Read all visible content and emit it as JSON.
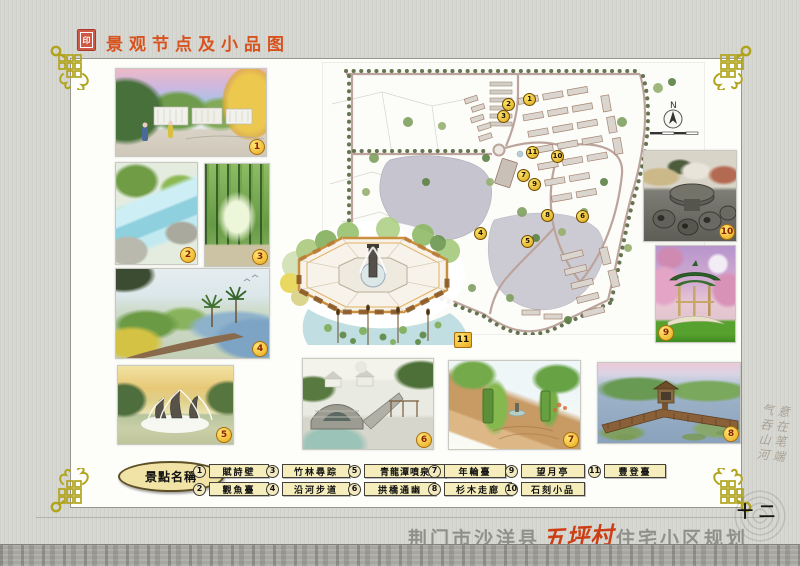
{
  "header": {
    "title": "景观节点及小品图"
  },
  "legend": {
    "title": "景點名稱",
    "items": [
      {
        "num": "1",
        "label": "賦詩壁"
      },
      {
        "num": "2",
        "label": "觀魚臺"
      },
      {
        "num": "3",
        "label": "竹林尋踪"
      },
      {
        "num": "4",
        "label": "沿河步道"
      },
      {
        "num": "5",
        "label": "青龍潭噴泉"
      },
      {
        "num": "6",
        "label": "拱橋通幽"
      },
      {
        "num": "7",
        "label": "年輪臺"
      },
      {
        "num": "8",
        "label": "杉木走廊"
      },
      {
        "num": "9",
        "label": "望月亭"
      },
      {
        "num": "10",
        "label": "石刻小品"
      },
      {
        "num": "11",
        "label": "豐登臺"
      }
    ]
  },
  "photos": {
    "badges": [
      "1",
      "2",
      "3",
      "4",
      "5",
      "6",
      "7",
      "8",
      "9",
      "10",
      "11"
    ]
  },
  "map": {
    "north_label": "N",
    "badges": [
      "1",
      "2",
      "3",
      "4",
      "5",
      "6",
      "7",
      "8",
      "9",
      "10",
      "11"
    ]
  },
  "footer": {
    "project_location": "荆门市沙洋县",
    "project_accent": "五坪村",
    "project_suffix": "住宅小区规划",
    "page_number": "十二"
  },
  "side_note": {
    "column1": "意在笔端",
    "column2": "气吞山河"
  },
  "colors": {
    "title_red": "#d8521e",
    "accent_red": "#cc3f14",
    "gold_ornament": "#b1a41d",
    "legend_cream": "#f5edbb",
    "paper_gray": "#d7d7d2"
  }
}
